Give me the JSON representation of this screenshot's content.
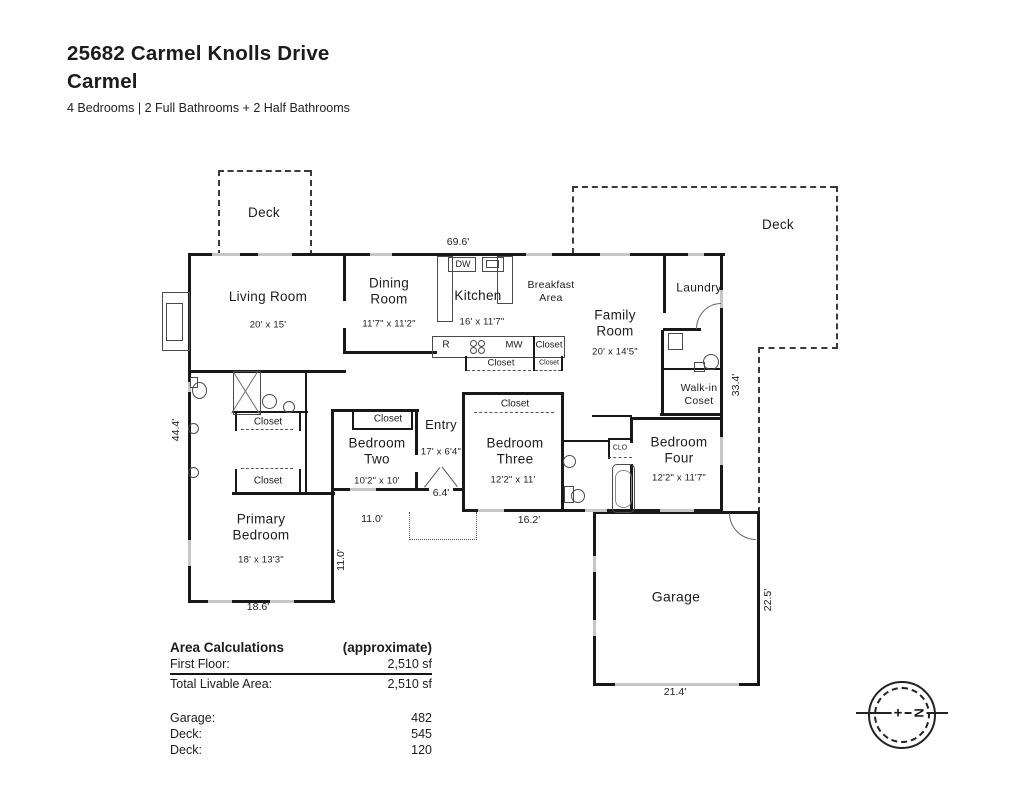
{
  "header": {
    "address": "25682 Carmel Knolls Drive",
    "city": "Carmel",
    "summary": "4 Bedrooms | 2 Full Bathrooms + 2 Half Bathrooms"
  },
  "rooms": {
    "deck_left": {
      "name": "Deck"
    },
    "deck_right": {
      "name": "Deck"
    },
    "living": {
      "name": "Living Room",
      "dims": "20' x 15'"
    },
    "dining": {
      "name": "Dining Room",
      "dims": "11'7\" x 11'2\""
    },
    "kitchen": {
      "name": "Kitchen",
      "dims": "16' x 11'7\""
    },
    "breakfast": {
      "name": "Breakfast Area"
    },
    "family": {
      "name": "Family Room",
      "dims": "20' x 14'5\""
    },
    "laundry": {
      "name": "Laundry"
    },
    "walkin": {
      "name": "Walk-in Coset"
    },
    "entry": {
      "name": "Entry",
      "dims": "17' x 6'4\""
    },
    "bedroom2": {
      "name": "Bedroom Two",
      "dims": "10'2\" x 10'"
    },
    "bedroom3": {
      "name": "Bedroom Three",
      "dims": "12'2\" x 11'"
    },
    "bedroom4": {
      "name": "Bedroom Four",
      "dims": "12'2\" x 11'7\""
    },
    "primary": {
      "name": "Primary Bedroom",
      "dims": "18' x 13'3\""
    },
    "garage": {
      "name": "Garage"
    }
  },
  "fixtures": {
    "dishwasher": "DW",
    "range": "R",
    "microwave": "MW",
    "small_closet": "CLO",
    "closet": "Closet"
  },
  "dimensions": {
    "top_width": "69.6'",
    "left_height": "44.4'",
    "right_height": "33.4'",
    "garage_height": "22.5'",
    "garage_width": "21.4'",
    "primary_width": "18.6'",
    "bedroom3_width": "16.2'",
    "bedroom2_width": "11.0'",
    "primary_side": "11.0'",
    "entry_width": "6.4'"
  },
  "area_table": {
    "title": "Area Calculations",
    "qualifier": "(approximate)",
    "rows": [
      {
        "label": "First Floor:",
        "value": "2,510 sf"
      },
      {
        "label": "Total Livable Area:",
        "value": "2,510 sf"
      }
    ],
    "extras": [
      {
        "label": "Garage:",
        "value": "482"
      },
      {
        "label": "Deck:",
        "value": "545"
      },
      {
        "label": "Deck:",
        "value": "120"
      }
    ]
  },
  "compass": {
    "north": "N",
    "center": "+"
  }
}
